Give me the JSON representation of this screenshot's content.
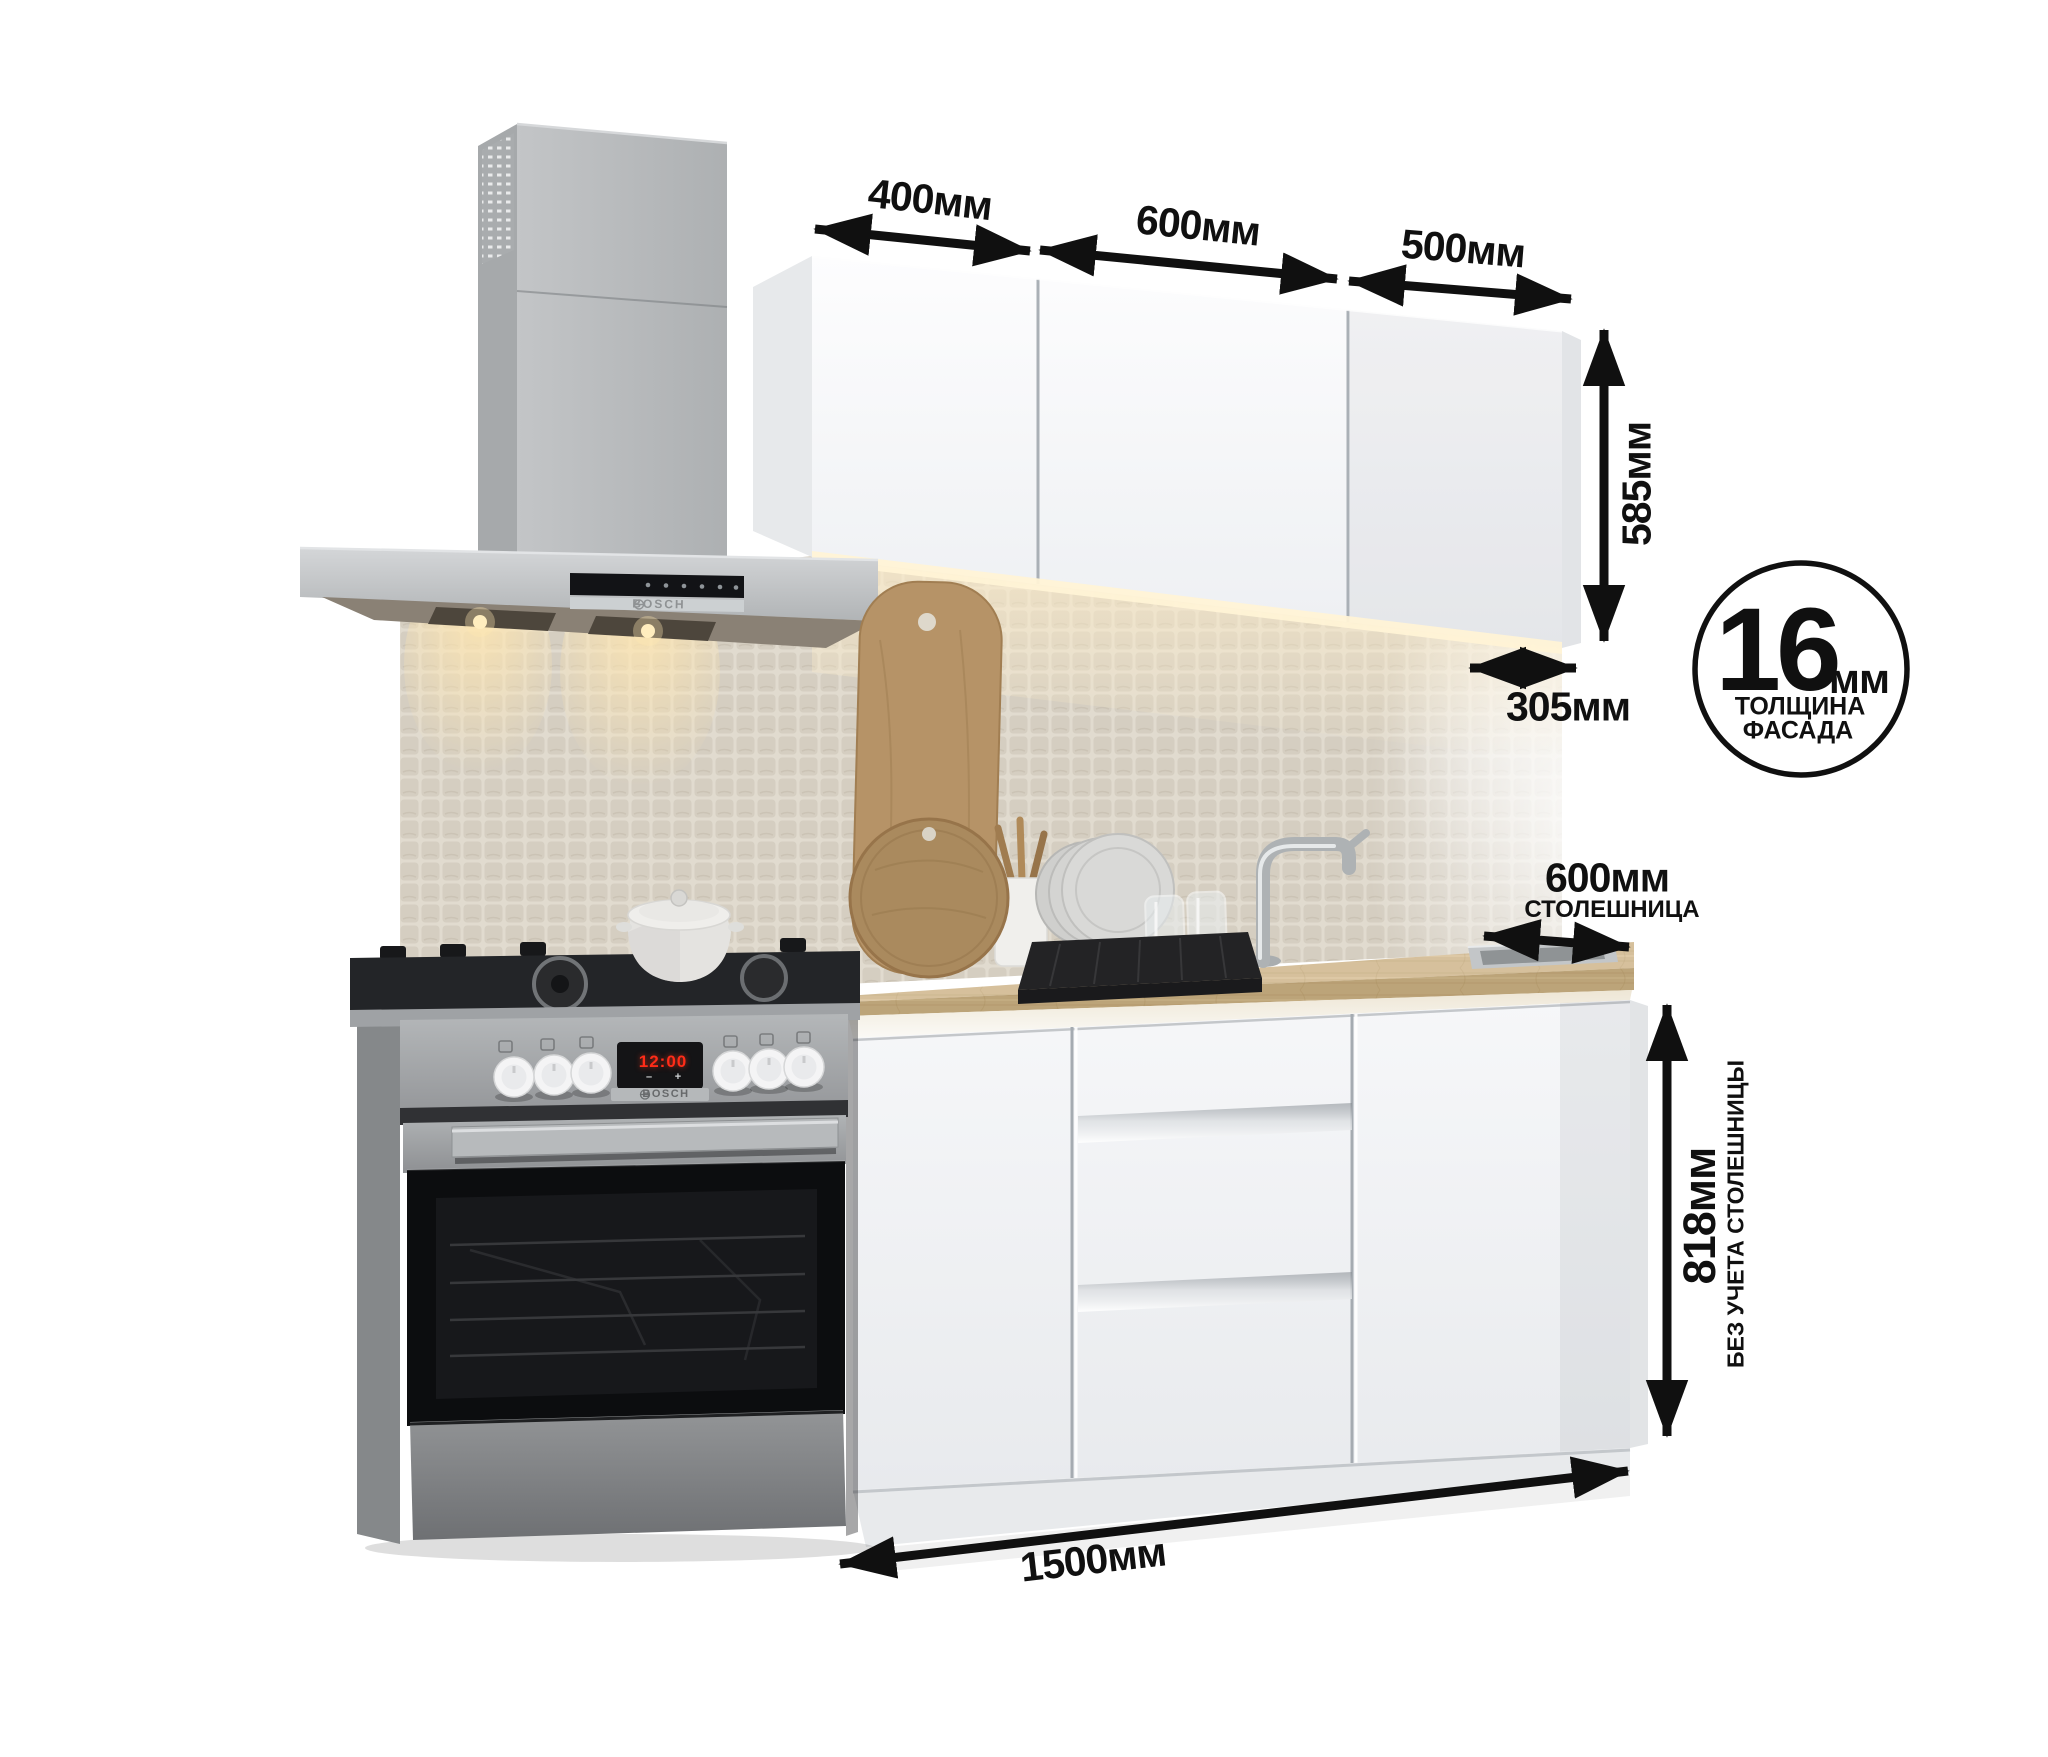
{
  "scene": {
    "description": "Белый кухонный гарнитур 1500 мм с вытяжкой и плитой Bosch, размерная схема",
    "background": "#ffffff"
  },
  "dimension_labels": {
    "upper_widths": [
      "400мм",
      "600мм",
      "500мм"
    ],
    "upper_height": "585мм",
    "upper_depth": "305мм",
    "facade_thickness": {
      "value": "16",
      "unit": "мм",
      "caption_line1": "ТОЛЩИНА",
      "caption_line2": "ФАСАДА"
    },
    "countertop": {
      "depth": "600мм",
      "caption": "СТОЛЕШНИЦА"
    },
    "base_height": {
      "value": "818мм",
      "caption": "БЕЗ УЧЕТА СТОЛЕШНИЦЫ"
    },
    "total_width": "1500мм"
  },
  "appliances": {
    "hood": {
      "brand": "BOSCH"
    },
    "stove": {
      "brand": "BOSCH",
      "clock": "12:00",
      "minus": "–",
      "plus": "+"
    }
  },
  "colors": {
    "annotation": "#101010",
    "cabinet_front": "#f4f5f7",
    "countertop_wood": "#cdb289",
    "steel": "#a6a9ab",
    "mosaic": "#d8d2c6",
    "led_warm": "#ffeec9",
    "display_red": "#ff2c18"
  }
}
